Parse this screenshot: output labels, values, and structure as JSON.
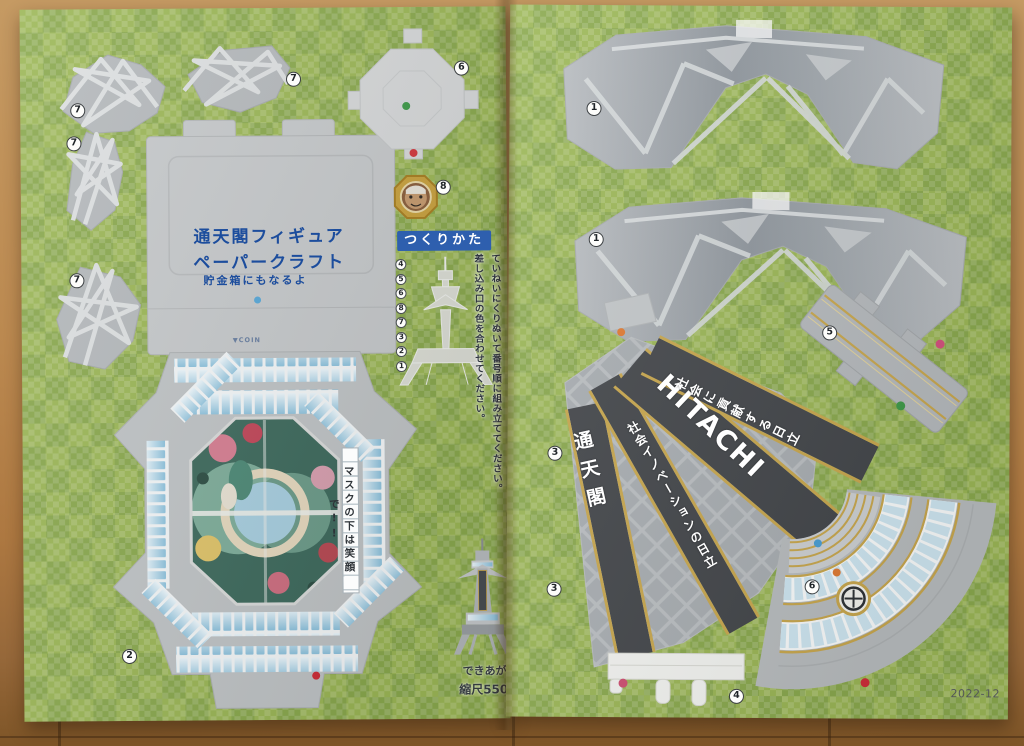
{
  "colors": {
    "page_green": "#9cb757",
    "piece_gray": "#c0c4c6",
    "band_dark": "#44474b",
    "gold_trim": "#c9a84f",
    "window_blue": "#8ec3de",
    "title_blue": "#1c4d9d",
    "howto_band_blue": "#2e5fae",
    "dot_green": "#3f9a4a",
    "dot_red": "#d2383f",
    "dot_blue": "#4a9fd4",
    "dot_orange": "#e07b33",
    "dot_pink": "#d4527e",
    "wood_brown": "#b9854d"
  },
  "left_page": {
    "title_line1": "通天閣フィギュア",
    "title_line2": "ペーパークラフト",
    "subtitle": "貯金箱にもなるよ",
    "coin_label": "▼COIN",
    "howto": {
      "title": "つくりかた",
      "steps": [
        "4",
        "5",
        "6",
        "8",
        "7",
        "3",
        "2",
        "1"
      ]
    },
    "instructions": {
      "line1": "ていねいにくりぬいて番号順に組み立ててください。",
      "line2": "差し込み口の色を合わせてください。"
    },
    "mask_message": "マスクの下は笑顔で!!",
    "finished": {
      "label": "できあがり",
      "scale": "縮尺550:1"
    },
    "piece_numbers": {
      "star_a": "7",
      "star_b": "7",
      "star_c": "7",
      "star_d": "7",
      "roof": "6",
      "medal": "8",
      "base": "2"
    }
  },
  "right_page": {
    "piece_numbers": {
      "leg_a": "1",
      "leg_b": "1",
      "rail": "5",
      "fan_upper": "3",
      "fan_lower": "3",
      "comb": "4",
      "arc": "6"
    },
    "bands": {
      "tsutenkaku": "通天閣",
      "innovation": "社会イノベーションの日立",
      "hitachi": "HITACHI",
      "slogan": "社会に貢献する日立"
    },
    "date_code": "2022-12"
  }
}
